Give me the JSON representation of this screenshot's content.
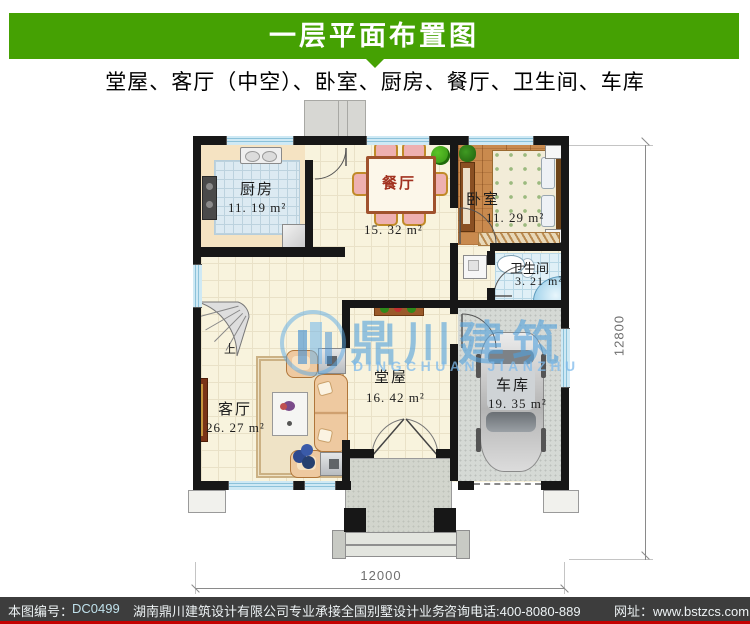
{
  "header": {
    "title": "一层平面布置图"
  },
  "subtitle": "堂屋、客厅（中空）、卧室、厨房、餐厅、卫生间、车库",
  "watermark": {
    "name_cn": "鼎川建筑",
    "name_en": "DINGCHUAN JIANZHU"
  },
  "rooms": {
    "kitchen": {
      "name": "厨房",
      "area": "11. 19 m²"
    },
    "dining": {
      "name": "餐厅",
      "area": "15. 32 m²"
    },
    "bedroom": {
      "name": "卧室",
      "area": "11. 29 m²"
    },
    "bathroom": {
      "name": "卫生间",
      "area": "3. 21 m²"
    },
    "hall": {
      "name": "堂屋",
      "area": "16. 42 m²"
    },
    "living": {
      "name": "客厅",
      "area": "26. 27 m²"
    },
    "garage": {
      "name": "车库",
      "area": "19. 35 m²"
    }
  },
  "stairs": {
    "label": "上"
  },
  "dimensions": {
    "right": "12800",
    "bottom": "12000"
  },
  "footer": {
    "no_label": "本图编号：",
    "no_value": "DC0499",
    "company": "湖南鼎川建筑设计有限公司专业承接全国别墅设计业务",
    "phone": "咨询电话:400-8080-889",
    "website": "网址：www.bstzcs.com"
  },
  "colors": {
    "accent_green": "#45a103",
    "footer_bar": "#3d3d3d",
    "footer_red": "#c40000",
    "watermark_blue": "#4a9edd"
  }
}
